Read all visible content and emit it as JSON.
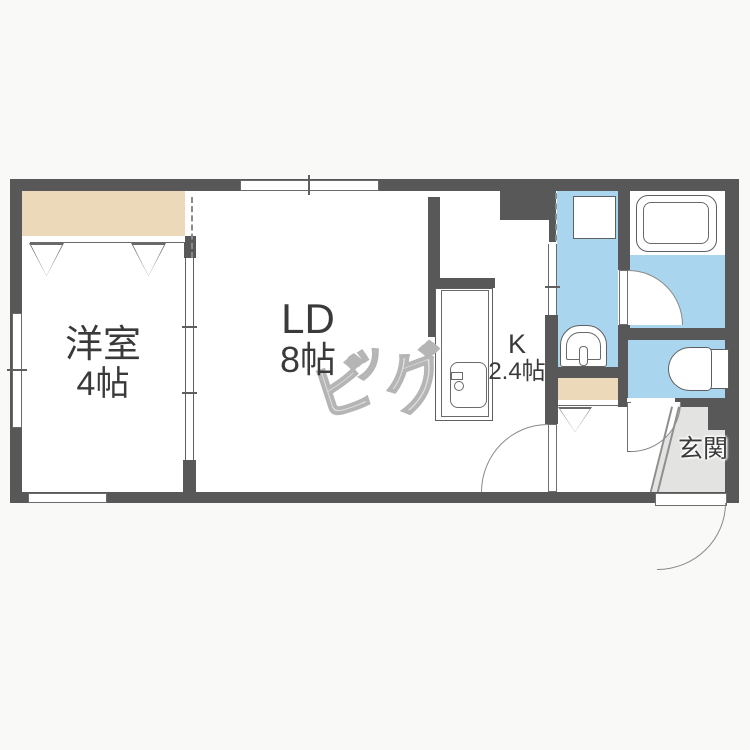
{
  "plan": {
    "type": "floorplan",
    "rooms": {
      "western": {
        "label": "洋室",
        "size": "4帖"
      },
      "living_dining": {
        "label": "LD",
        "size": "8帖"
      },
      "kitchen": {
        "label": "K",
        "size": "2.4帖"
      },
      "entrance": {
        "label": "玄関"
      }
    },
    "watermark": {
      "text": "ビッグ",
      "char1": "ビ",
      "char2": "ッ",
      "char3": "グ"
    },
    "colors": {
      "wall": "#585858",
      "water_area": "#a9d6ee",
      "closet": "#ecd9ba",
      "entrance_tile": "#e3e3e1",
      "text": "#3a3a3a",
      "watermark_outline": "#b5b5b5",
      "background": "#f9f9f7"
    },
    "fixtures": [
      "bathtub",
      "washing-machine-pan",
      "wash-basin",
      "toilet",
      "kitchen-sink",
      "closet-hangers",
      "shoe-closet"
    ]
  }
}
